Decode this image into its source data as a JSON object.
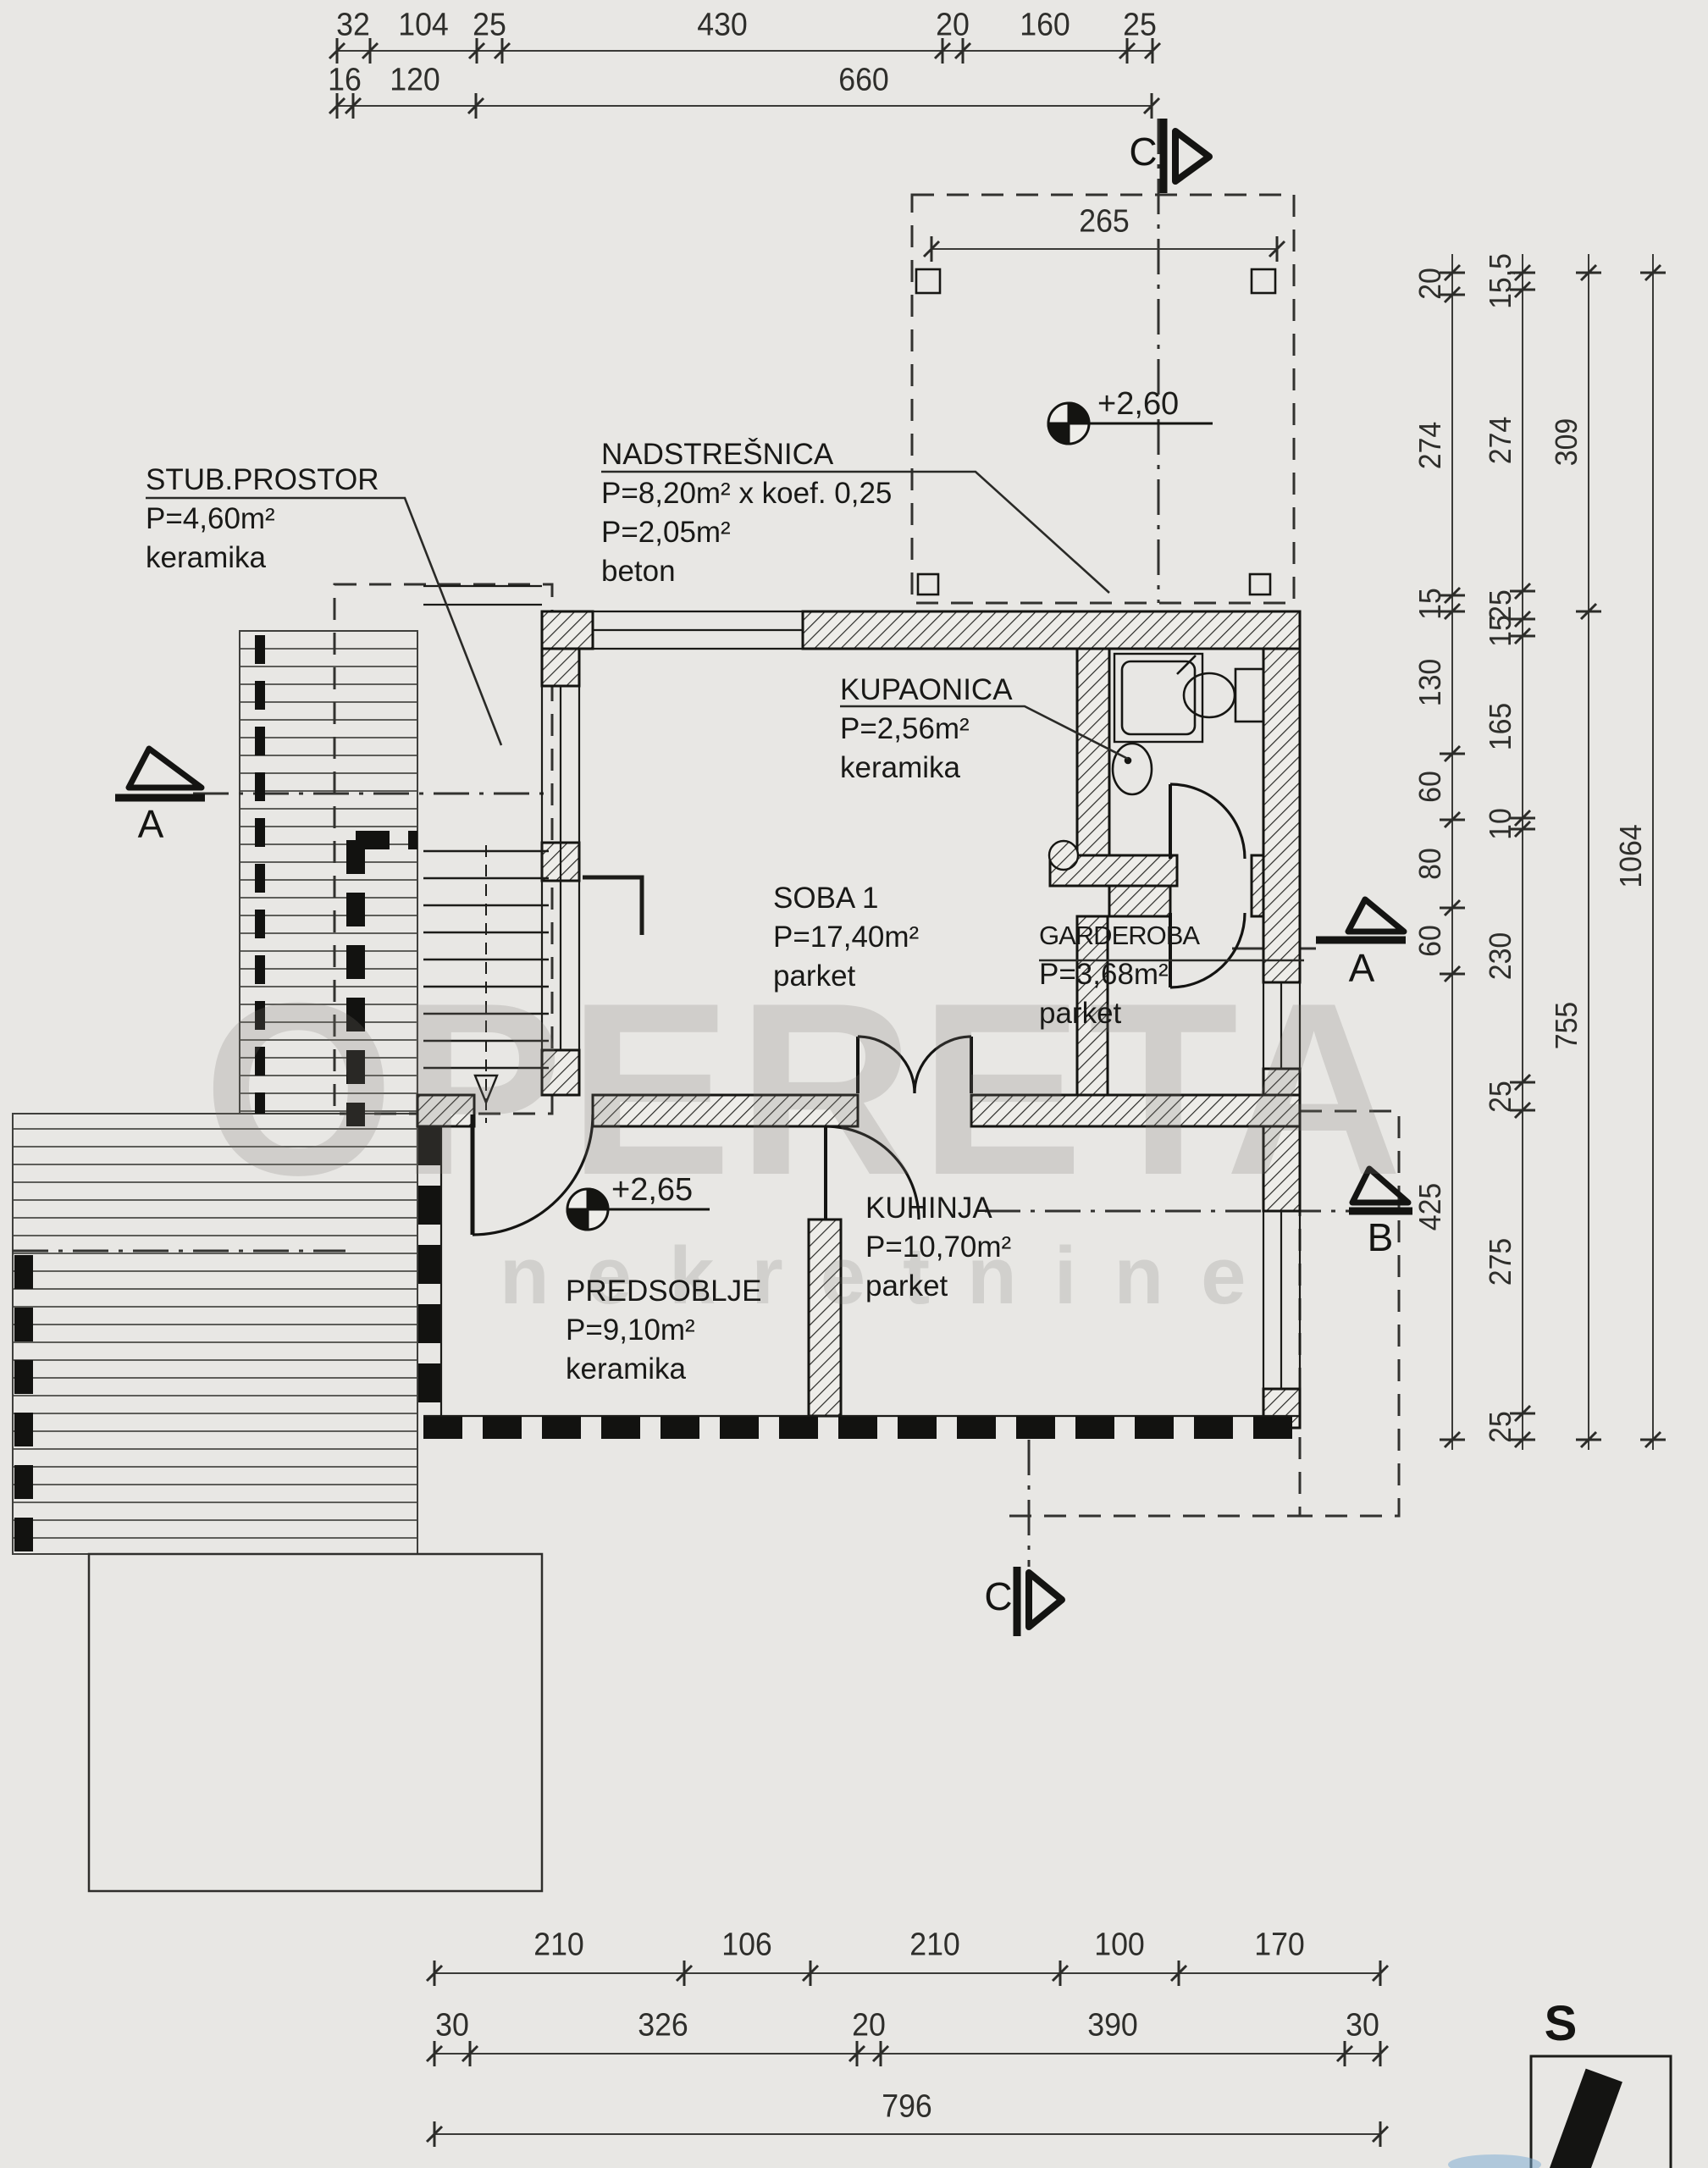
{
  "watermark": {
    "line1": "OPERETA",
    "line2": "nekretnine"
  },
  "north": {
    "label": "S"
  },
  "sections": {
    "top_c": "C",
    "bottom_c": "C",
    "left_a": "A",
    "right_a": "A",
    "right_b": "B"
  },
  "levels": {
    "canopy": "+2,60",
    "hall": "+2,65"
  },
  "rooms": {
    "nadstresnica": {
      "name": "NADSTREŠNICA",
      "l2": "P=8,20m² x koef. 0,25",
      "l3": "P=2,05m²",
      "l4": "beton"
    },
    "stub": {
      "name": "STUB.PROSTOR",
      "l2": "P=4,60m²",
      "l3": "keramika"
    },
    "kupaonica": {
      "name": "KUPAONICA",
      "l2": "P=2,56m²",
      "l3": "keramika"
    },
    "soba1": {
      "name": "SOBA 1",
      "l2": "P=17,40m²",
      "l3": "parket"
    },
    "garderoba": {
      "name": "GARDEROBA",
      "l2": "P=3,68m²",
      "l3": "parket"
    },
    "kuhinja": {
      "name": "KUHINJA",
      "l2": "P=10,70m²",
      "l3": "parket"
    },
    "predsoblje": {
      "name": "PREDSOBLJE",
      "l2": "P=9,10m²",
      "l3": "keramika"
    }
  },
  "dims": {
    "top1": [
      "32",
      "104",
      "25",
      "430",
      "20",
      "160",
      "25"
    ],
    "top2": [
      "16",
      "120",
      "660"
    ],
    "canopy": [
      "265"
    ],
    "right1": [
      "20",
      "274",
      "15",
      "130",
      "60",
      "80",
      "60",
      "425"
    ],
    "right2": [
      "15,5",
      "274",
      "25",
      "15",
      "165",
      "10",
      "230",
      "25",
      "275",
      "25"
    ],
    "right3": [
      "309",
      "755"
    ],
    "right4": [
      "1064"
    ],
    "bottom1": [
      "210",
      "106",
      "210",
      "100",
      "170"
    ],
    "bottom2": [
      "30",
      "326",
      "20",
      "390",
      "30"
    ],
    "bottom3": [
      "796"
    ]
  },
  "colors": {
    "paper": "#e8e7e4",
    "ink": "#22221f",
    "wall": "#141412"
  }
}
